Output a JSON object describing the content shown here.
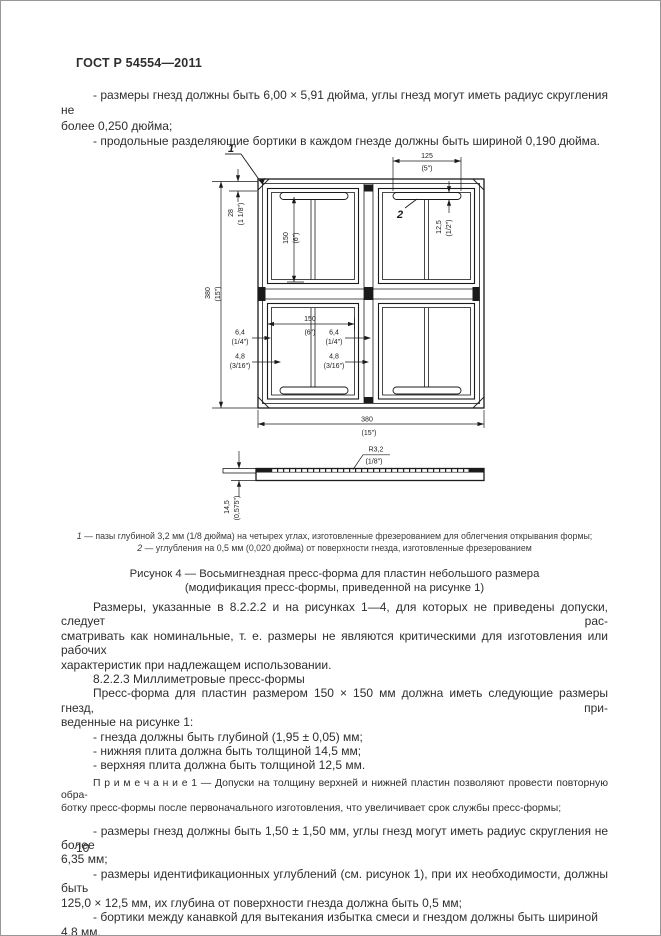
{
  "page": {
    "header": "ГОСТ Р 54554—2011",
    "number": "10"
  },
  "intro": {
    "p1_l1": "- размеры гнезд должны быть 6,00 × 5,91 дюйма, углы гнезд могут иметь радиус скругления не",
    "p1_l2": "более 0,250 дюйма;",
    "p2": "- продольные разделяющие бортики в каждом гнезде должны быть шириной 0,190 дюйма."
  },
  "figure": {
    "callout1": "1",
    "callout2": "2",
    "dims": {
      "d125": {
        "mm": "125",
        "in": "(5\")"
      },
      "d12_5": {
        "mm": "12,5",
        "in": "(1/2\")"
      },
      "d28": {
        "mm": "28",
        "in": "(1 1/8\")"
      },
      "d150v": {
        "mm": "150",
        "in": "(6\")"
      },
      "d380l": {
        "mm": "380",
        "in": "(15\")"
      },
      "d150h": {
        "mm": "150",
        "in": "(6\")"
      },
      "d64l": {
        "mm": "6,4",
        "in": "(1/4\")"
      },
      "d64r": {
        "mm": "6,4",
        "in": "(1/4\")"
      },
      "d48l": {
        "mm": "4,8",
        "in": "(3/16\")"
      },
      "d48r": {
        "mm": "4,8",
        "in": "(3/16\")"
      },
      "d380b": {
        "mm": "380",
        "in": "(15\")"
      },
      "r32": {
        "mm": "R3,2",
        "in": "(1/8\")"
      },
      "d14_5": {
        "mm": "14,5",
        "in": "(0,575\")"
      }
    },
    "footnotes": [
      {
        "num": "1",
        "text": "— пазы глубиной 3,2 мм (1/8 дюйма) на четырех углах, изготовленные фрезерованием для облегчения открывания формы;"
      },
      {
        "num": "2",
        "text": "— углубления на 0,5 мм (0,020 дюйма) от поверхности гнезда, изготовленные фрезерованием"
      }
    ],
    "caption_l1": "Рисунок 4 — Восьмигнездная пресс-форма для пластин небольшого размера",
    "caption_l2": "(модификация пресс-формы, приведенной на рисунке 1)"
  },
  "body": {
    "p1_l1": "Размеры, указанные в 8.2.2.2 и на рисунках 1—4, для которых не приведены допуски, следует рас-",
    "p1_l2": "сматривать как номинальные, т. е. размеры не являются критическими для изготовления или рабочих",
    "p1_l3": "характеристик при надлежащем использовании.",
    "p2": "8.2.2.3 Миллиметровые пресс-формы",
    "p3_l1": "Пресс-форма для пластин размером 150 × 150 мм должна иметь следующие размеры гнезд, при-",
    "p3_l2": "веденные на рисунке 1:",
    "b1": "- гнезда должны быть глубиной (1,95 ± 0,05) мм;",
    "b2": "- нижняя плита должна быть толщиной 14,5 мм;",
    "b3": "- верхняя плита должна быть толщиной 12,5 мм.",
    "note_l1": "П р и м е ч а н и е   1 — Допуски на толщину верхней и нижней пластин позволяют провести повторную обра-",
    "note_l2": "ботку пресс-формы после первоначального изготовления, что увеличивает срок службы пресс-формы;",
    "b4_l1": "- размеры гнезд должны быть 1,50 ± 1,50 мм, углы гнезд могут иметь радиус скругления не более",
    "b4_l2": "6,35 мм;",
    "b5_l1": "- размеры идентификационных углублений (см. рисунок 1), при их необходимости, должны быть",
    "b5_l2": "125,0 × 12,5 мм, их глубина от поверхности гнезда должна быть 0,5 мм;",
    "b6": "- бортики между канавкой для вытекания избытка смеси и гнездом должны быть шириной 4,8 мм."
  }
}
